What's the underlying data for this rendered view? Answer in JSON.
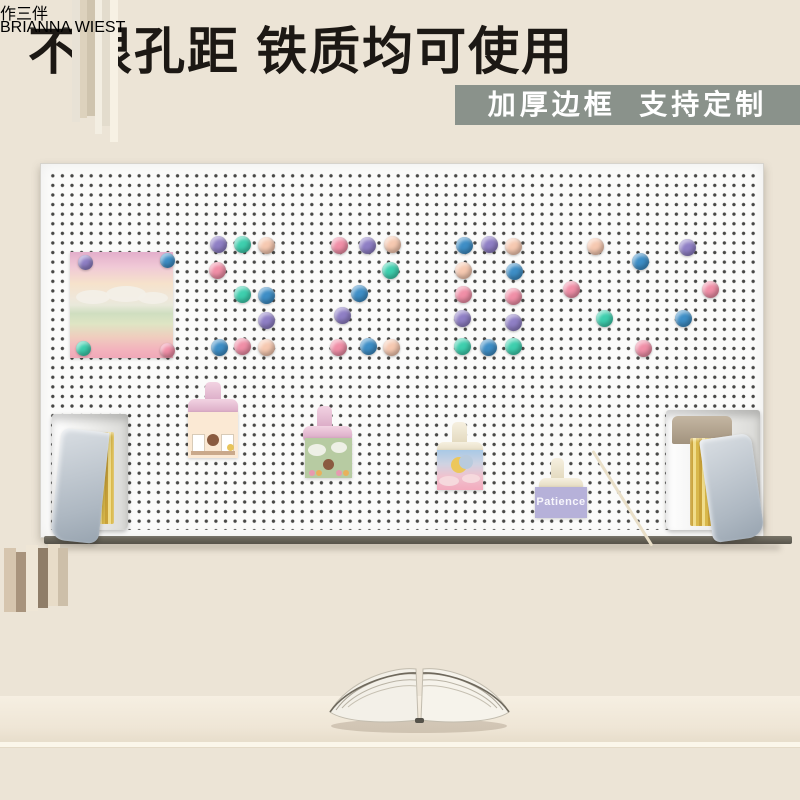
{
  "header": {
    "title": "不限孔距 铁质均可使用",
    "badge": "加厚边框  支持定制"
  },
  "pegboard": {
    "patience_card": "Patience",
    "magnet_colors": {
      "purple": "#8f7fc5",
      "mint": "#3ecfae",
      "peach": "#f6c9b1",
      "pink": "#f08fa7",
      "blue": "#3e8ec6"
    },
    "photo_magnets": [
      {
        "x": 85,
        "y": 262,
        "c": "purple"
      },
      {
        "x": 167,
        "y": 260,
        "c": "blue"
      },
      {
        "x": 83,
        "y": 348,
        "c": "mint"
      },
      {
        "x": 167,
        "y": 350,
        "c": "pink"
      }
    ],
    "pins": [
      {
        "x": 218,
        "y": 244,
        "c": "purple"
      },
      {
        "x": 242,
        "y": 244,
        "c": "mint"
      },
      {
        "x": 266,
        "y": 245,
        "c": "peach"
      },
      {
        "x": 339,
        "y": 245,
        "c": "pink"
      },
      {
        "x": 367,
        "y": 245,
        "c": "purple"
      },
      {
        "x": 392,
        "y": 244,
        "c": "peach"
      },
      {
        "x": 464,
        "y": 245,
        "c": "blue"
      },
      {
        "x": 489,
        "y": 244,
        "c": "purple"
      },
      {
        "x": 513,
        "y": 246,
        "c": "peach"
      },
      {
        "x": 595,
        "y": 246,
        "c": "peach"
      },
      {
        "x": 687,
        "y": 247,
        "c": "purple"
      },
      {
        "x": 640,
        "y": 261,
        "c": "blue"
      },
      {
        "x": 217,
        "y": 270,
        "c": "pink"
      },
      {
        "x": 390,
        "y": 270,
        "c": "mint"
      },
      {
        "x": 463,
        "y": 270,
        "c": "peach"
      },
      {
        "x": 514,
        "y": 271,
        "c": "blue"
      },
      {
        "x": 571,
        "y": 289,
        "c": "pink"
      },
      {
        "x": 710,
        "y": 289,
        "c": "pink"
      },
      {
        "x": 242,
        "y": 294,
        "c": "mint"
      },
      {
        "x": 266,
        "y": 295,
        "c": "blue"
      },
      {
        "x": 359,
        "y": 293,
        "c": "blue"
      },
      {
        "x": 463,
        "y": 294,
        "c": "pink"
      },
      {
        "x": 513,
        "y": 296,
        "c": "pink"
      },
      {
        "x": 342,
        "y": 315,
        "c": "purple"
      },
      {
        "x": 266,
        "y": 320,
        "c": "purple"
      },
      {
        "x": 462,
        "y": 318,
        "c": "purple"
      },
      {
        "x": 604,
        "y": 318,
        "c": "mint"
      },
      {
        "x": 683,
        "y": 318,
        "c": "blue"
      },
      {
        "x": 513,
        "y": 322,
        "c": "purple"
      },
      {
        "x": 219,
        "y": 347,
        "c": "blue"
      },
      {
        "x": 242,
        "y": 346,
        "c": "pink"
      },
      {
        "x": 266,
        "y": 347,
        "c": "peach"
      },
      {
        "x": 338,
        "y": 347,
        "c": "pink"
      },
      {
        "x": 368,
        "y": 346,
        "c": "blue"
      },
      {
        "x": 391,
        "y": 347,
        "c": "peach"
      },
      {
        "x": 462,
        "y": 346,
        "c": "mint"
      },
      {
        "x": 488,
        "y": 347,
        "c": "blue"
      },
      {
        "x": 513,
        "y": 346,
        "c": "mint"
      },
      {
        "x": 643,
        "y": 348,
        "c": "pink"
      }
    ]
  },
  "desk": {
    "tall_book_spine": "作三伴",
    "book_stack_title": "BRIANNA WIEST"
  }
}
